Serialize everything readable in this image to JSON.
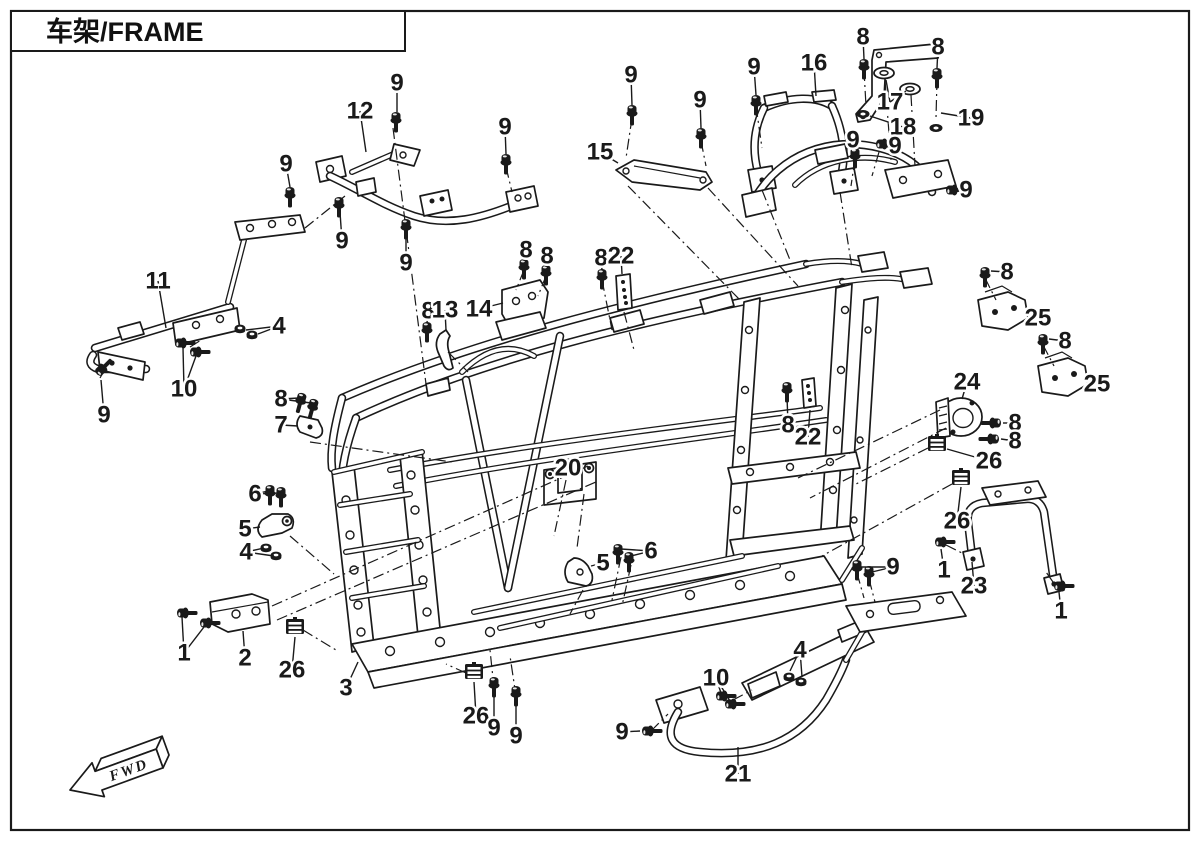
{
  "page": {
    "title": "车架/FRAME",
    "fwd_label": "FWD"
  },
  "colors": {
    "line": "#1a1a1a",
    "background": "#ffffff"
  },
  "callouts": [
    {
      "n": "9",
      "x": 397,
      "y": 83,
      "t": [
        [
          397,
          112
        ]
      ]
    },
    {
      "n": "12",
      "x": 360,
      "y": 111,
      "t": [
        [
          366,
          152
        ]
      ]
    },
    {
      "n": "9",
      "x": 505,
      "y": 127,
      "t": [
        [
          506,
          154
        ]
      ]
    },
    {
      "n": "9",
      "x": 286,
      "y": 164,
      "t": [
        [
          290,
          187
        ]
      ]
    },
    {
      "n": "9",
      "x": 342,
      "y": 241,
      "t": [
        [
          340,
          212
        ]
      ]
    },
    {
      "n": "9",
      "x": 406,
      "y": 263,
      "t": [
        [
          406,
          236
        ]
      ]
    },
    {
      "n": "11",
      "x": 158,
      "y": 281,
      "t": [
        [
          166,
          328
        ]
      ]
    },
    {
      "n": "4",
      "x": 279,
      "y": 326,
      "t": [
        [
          258,
          334
        ],
        [
          246,
          330
        ]
      ]
    },
    {
      "n": "10",
      "x": 184,
      "y": 389,
      "t": [
        [
          183,
          348
        ],
        [
          196,
          356
        ]
      ]
    },
    {
      "n": "9",
      "x": 104,
      "y": 415,
      "t": [
        [
          101,
          380
        ]
      ]
    },
    {
      "n": "15",
      "x": 600,
      "y": 152,
      "t": [
        [
          618,
          163
        ]
      ]
    },
    {
      "n": "9",
      "x": 631,
      "y": 75,
      "t": [
        [
          632,
          105
        ]
      ]
    },
    {
      "n": "9",
      "x": 700,
      "y": 100,
      "t": [
        [
          701,
          128
        ]
      ]
    },
    {
      "n": "9",
      "x": 754,
      "y": 67,
      "t": [
        [
          756,
          95
        ]
      ]
    },
    {
      "n": "16",
      "x": 814,
      "y": 63,
      "t": [
        [
          816,
          96
        ]
      ]
    },
    {
      "n": "8",
      "x": 863,
      "y": 37,
      "t": [
        [
          864,
          59
        ]
      ]
    },
    {
      "n": "17",
      "x": 890,
      "y": 102,
      "t": [
        [
          886,
          80
        ],
        [
          906,
          91
        ]
      ]
    },
    {
      "n": "8",
      "x": 938,
      "y": 47,
      "t": [
        [
          937,
          68
        ]
      ]
    },
    {
      "n": "18",
      "x": 903,
      "y": 127,
      "t": [
        [
          870,
          116
        ]
      ]
    },
    {
      "n": "19",
      "x": 971,
      "y": 118,
      "t": [
        [
          941,
          113
        ]
      ]
    },
    {
      "n": "9",
      "x": 853,
      "y": 140,
      "t": [
        [
          855,
          149
        ]
      ]
    },
    {
      "n": "9",
      "x": 895,
      "y": 146,
      "t": [
        [
          884,
          145
        ]
      ]
    },
    {
      "n": "9",
      "x": 966,
      "y": 190,
      "t": [
        [
          952,
          190
        ]
      ]
    },
    {
      "n": "8",
      "x": 526,
      "y": 250,
      "t": [
        [
          524,
          261
        ]
      ]
    },
    {
      "n": "8",
      "x": 547,
      "y": 256,
      "t": [
        [
          546,
          267
        ]
      ]
    },
    {
      "n": "8",
      "x": 601,
      "y": 258,
      "t": [
        [
          602,
          270
        ]
      ]
    },
    {
      "n": "22",
      "x": 621,
      "y": 256,
      "t": [
        [
          622,
          274
        ]
      ]
    },
    {
      "n": "8",
      "x": 428,
      "y": 311,
      "t": [
        [
          427,
          323
        ]
      ]
    },
    {
      "n": "13",
      "x": 445,
      "y": 310,
      "t": [
        [
          446,
          330
        ]
      ]
    },
    {
      "n": "14",
      "x": 479,
      "y": 309,
      "t": [
        [
          503,
          303
        ]
      ]
    },
    {
      "n": "8",
      "x": 1007,
      "y": 272,
      "t": [
        [
          991,
          271
        ]
      ]
    },
    {
      "n": "25",
      "x": 1038,
      "y": 318,
      "t": [
        [
          1025,
          313
        ]
      ]
    },
    {
      "n": "8",
      "x": 1065,
      "y": 341,
      "t": [
        [
          1049,
          339
        ]
      ]
    },
    {
      "n": "25",
      "x": 1097,
      "y": 384,
      "t": [
        [
          1083,
          379
        ]
      ]
    },
    {
      "n": "24",
      "x": 967,
      "y": 382,
      "t": [
        [
          962,
          399
        ]
      ]
    },
    {
      "n": "8",
      "x": 1015,
      "y": 423,
      "t": [
        [
          1003,
          423
        ]
      ]
    },
    {
      "n": "8",
      "x": 1015,
      "y": 441,
      "t": [
        [
          1001,
          439
        ]
      ]
    },
    {
      "n": "26",
      "x": 989,
      "y": 461,
      "t": [
        [
          947,
          449
        ]
      ]
    },
    {
      "n": "8",
      "x": 788,
      "y": 425,
      "t": [
        [
          787,
          396
        ]
      ]
    },
    {
      "n": "22",
      "x": 808,
      "y": 437,
      "t": [
        [
          810,
          410
        ]
      ]
    },
    {
      "n": "26",
      "x": 957,
      "y": 521,
      "t": [
        [
          961,
          487
        ]
      ]
    },
    {
      "n": "9",
      "x": 893,
      "y": 567,
      "t": [
        [
          872,
          572
        ],
        [
          861,
          567
        ]
      ]
    },
    {
      "n": "1",
      "x": 944,
      "y": 570,
      "t": [
        [
          941,
          549
        ]
      ]
    },
    {
      "n": "23",
      "x": 974,
      "y": 586,
      "t": [
        [
          972,
          562
        ]
      ]
    },
    {
      "n": "1",
      "x": 1061,
      "y": 611,
      "t": [
        [
          1059,
          592
        ]
      ]
    },
    {
      "n": "20",
      "x": 568,
      "y": 468,
      "t": []
    },
    {
      "n": "8",
      "x": 281,
      "y": 399,
      "t": [
        [
          299,
          398
        ],
        [
          311,
          403
        ]
      ]
    },
    {
      "n": "7",
      "x": 281,
      "y": 425,
      "t": [
        [
          298,
          426
        ]
      ]
    },
    {
      "n": "6",
      "x": 255,
      "y": 494,
      "t": [
        [
          268,
          491
        ],
        [
          279,
          493
        ]
      ]
    },
    {
      "n": "5",
      "x": 245,
      "y": 529,
      "t": [
        [
          260,
          527
        ]
      ]
    },
    {
      "n": "4",
      "x": 246,
      "y": 552,
      "t": [
        [
          264,
          548
        ],
        [
          274,
          556
        ]
      ]
    },
    {
      "n": "5",
      "x": 603,
      "y": 563,
      "t": [
        [
          591,
          566
        ]
      ]
    },
    {
      "n": "6",
      "x": 651,
      "y": 551,
      "t": [
        [
          631,
          556
        ],
        [
          621,
          549
        ]
      ]
    },
    {
      "n": "1",
      "x": 184,
      "y": 653,
      "t": [
        [
          182,
          617
        ],
        [
          204,
          627
        ]
      ]
    },
    {
      "n": "2",
      "x": 245,
      "y": 658,
      "t": [
        [
          243,
          631
        ]
      ]
    },
    {
      "n": "26",
      "x": 292,
      "y": 670,
      "t": [
        [
          295,
          637
        ]
      ]
    },
    {
      "n": "3",
      "x": 346,
      "y": 688,
      "t": [
        [
          358,
          662
        ]
      ]
    },
    {
      "n": "26",
      "x": 476,
      "y": 716,
      "t": [
        [
          474,
          682
        ]
      ]
    },
    {
      "n": "9",
      "x": 494,
      "y": 728,
      "t": [
        [
          494,
          697
        ]
      ]
    },
    {
      "n": "9",
      "x": 516,
      "y": 736,
      "t": [
        [
          516,
          706
        ]
      ]
    },
    {
      "n": "9",
      "x": 622,
      "y": 732,
      "t": [
        [
          640,
          731
        ]
      ]
    },
    {
      "n": "10",
      "x": 716,
      "y": 678,
      "t": [
        [
          721,
          693
        ],
        [
          730,
          701
        ]
      ]
    },
    {
      "n": "4",
      "x": 800,
      "y": 650,
      "t": [
        [
          790,
          671
        ],
        [
          802,
          677
        ]
      ]
    },
    {
      "n": "21",
      "x": 738,
      "y": 774,
      "t": [
        [
          738,
          747
        ]
      ]
    }
  ]
}
